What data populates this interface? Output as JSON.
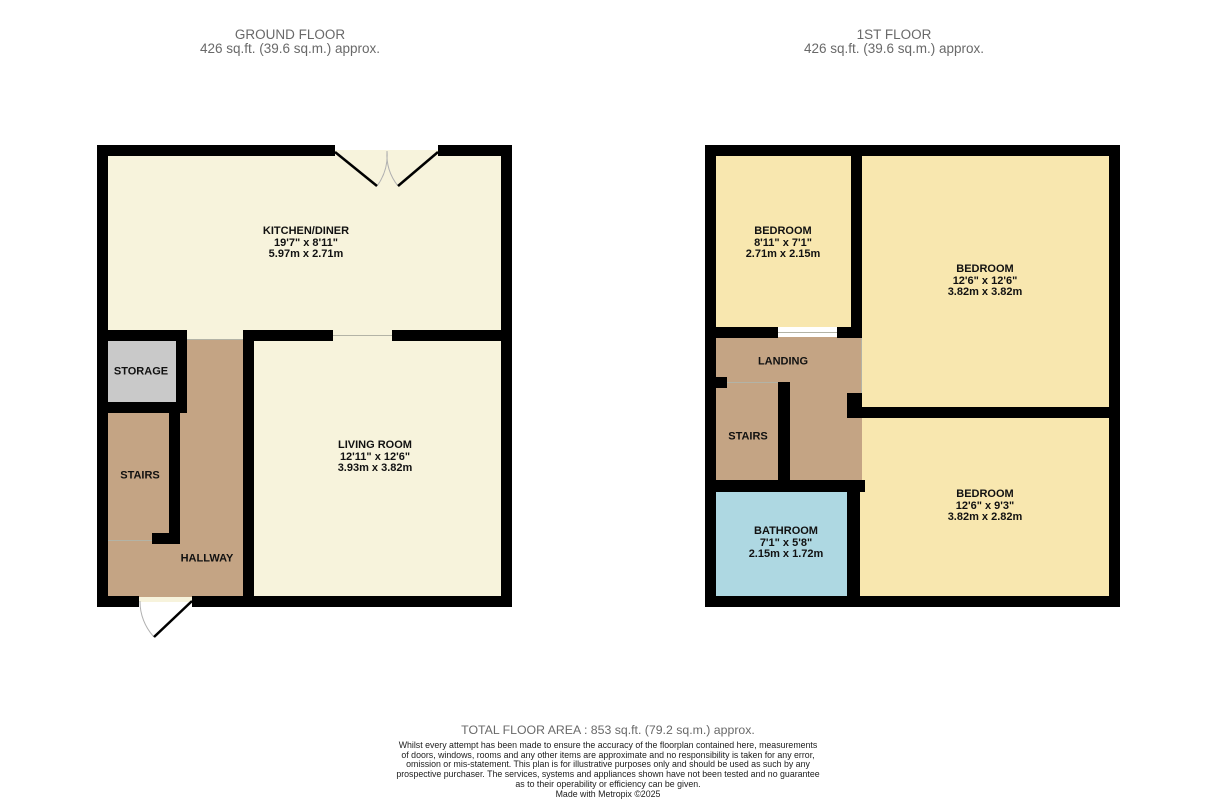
{
  "colors": {
    "wall": "#000000",
    "cream": "#f7f3dc",
    "yellow": "#f8e7af",
    "tan": "#c4a484",
    "gray": "#c9c9c9",
    "blue": "#aed8e2",
    "thin_line": "#b3b3a6",
    "door_arc": "#b0b0b0"
  },
  "ground_floor": {
    "title": "GROUND FLOOR",
    "area": "426 sq.ft. (39.6 sq.m.) approx.",
    "rooms": [
      {
        "name": "KITCHEN/DINER",
        "dims_ft": "19'7\"  x 8'11\"",
        "dims_m": "5.97m  x 2.71m"
      },
      {
        "name": "STORAGE"
      },
      {
        "name": "STAIRS"
      },
      {
        "name": "HALLWAY"
      },
      {
        "name": "LIVING ROOM",
        "dims_ft": "12'11\"  x 12'6\"",
        "dims_m": "3.93m  x 3.82m"
      }
    ]
  },
  "first_floor": {
    "title": "1ST FLOOR",
    "area": "426 sq.ft. (39.6 sq.m.) approx.",
    "rooms": [
      {
        "name": "BEDROOM",
        "dims_ft": "8'11\"  x 7'1\"",
        "dims_m": "2.71m  x 2.15m"
      },
      {
        "name": "BEDROOM",
        "dims_ft": "12'6\"  x 12'6\"",
        "dims_m": "3.82m  x 3.82m"
      },
      {
        "name": "LANDING"
      },
      {
        "name": "STAIRS"
      },
      {
        "name": "BATHROOM",
        "dims_ft": "7'1\"  x 5'8\"",
        "dims_m": "2.15m  x 1.72m"
      },
      {
        "name": "BEDROOM",
        "dims_ft": "12'6\"  x 9'3\"",
        "dims_m": "3.82m  x 2.82m"
      }
    ]
  },
  "footer": {
    "total_area": "TOTAL FLOOR AREA : 853 sq.ft. (79.2 sq.m.) approx.",
    "disclaimer_lines": [
      "Whilst every attempt has been made to ensure the accuracy of the floorplan contained here, measurements",
      "of doors, windows, rooms and any other items are approximate and no responsibility is taken for any error,",
      "omission or mis-statement. This plan is for illustrative purposes only and should be used as such by any",
      "prospective purchaser. The services, systems and appliances shown have not been tested and no guarantee",
      "as to their operability or efficiency can be given."
    ],
    "credit": "Made with Metropix ©2025"
  }
}
